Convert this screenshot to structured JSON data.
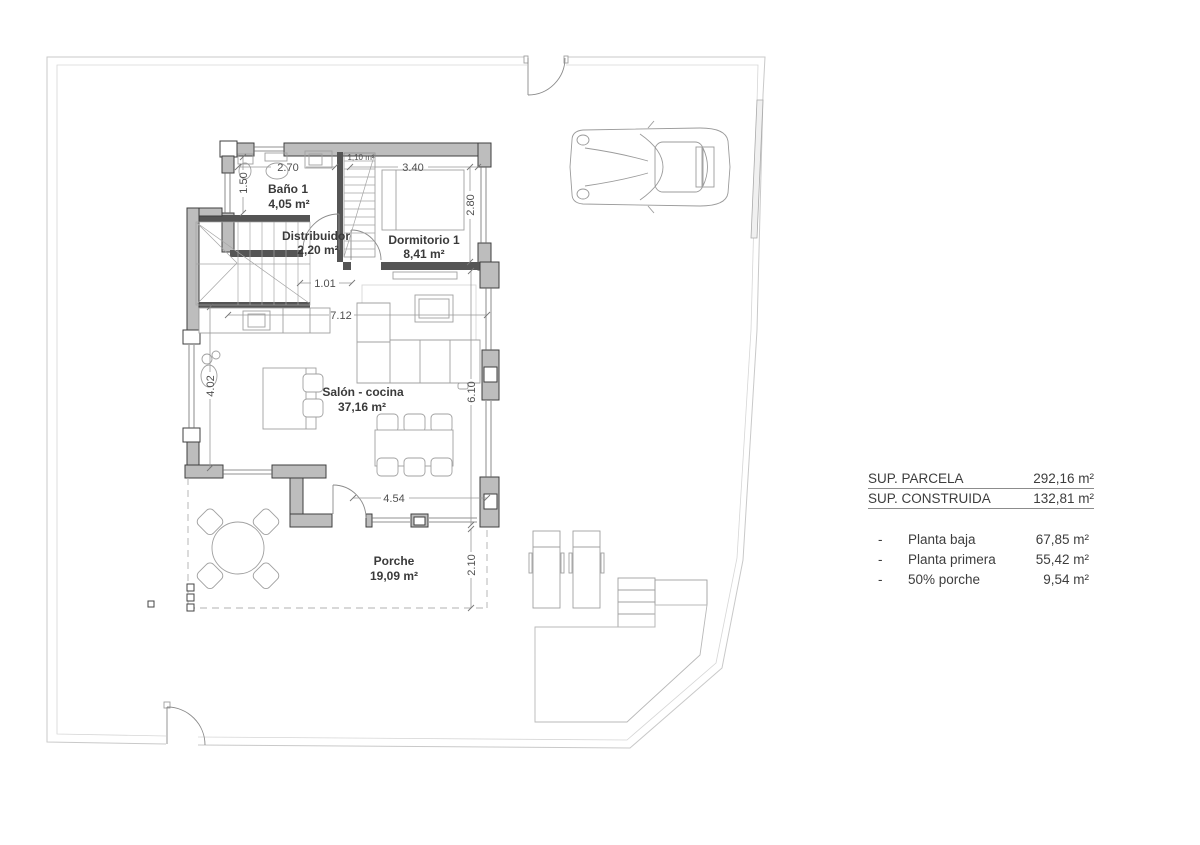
{
  "colors": {
    "wall_fill": "#bdbdbd",
    "wall_dark": "#555555",
    "wall_stroke": "#3f3f3f",
    "furniture_line": "#a0a0a0",
    "boundary_line": "#c9c9c9",
    "dashed_line": "#b0b0b0",
    "room_text": "#3a3a3a",
    "dim_text": "#4f4f4f",
    "summary_text": "#3d3d3d"
  },
  "rooms": {
    "bano": {
      "name": "Baño 1",
      "area": "4,05 m²"
    },
    "distribuidor": {
      "name": "Distribuidor",
      "area": "2,20 m²"
    },
    "dormitorio": {
      "name": "Dormitorio 1",
      "area": "8,41 m²"
    },
    "salon": {
      "name": "Salón - cocina",
      "area": "37,16 m²"
    },
    "porche": {
      "name": "Porche",
      "area": "19,09 m²"
    }
  },
  "dims": {
    "bano_width": "2.70",
    "stair_area": "1,10 m²",
    "dorm_width": "3.40",
    "bano_window": "1.50",
    "dorm_depth": "2.80",
    "hall_width": "1.01",
    "salon_width": "7.12",
    "salon_window_left": "4.02",
    "salon_window_right": "6.10",
    "porch_width": "4.54",
    "porch_depth": "2.10"
  },
  "summary": {
    "rows": [
      {
        "label": "SUP. PARCELA",
        "value": "292,16 m²"
      },
      {
        "label": "SUP. CONSTRUIDA",
        "value": "132,81 m²"
      }
    ],
    "items": [
      {
        "bullet": "-",
        "label": "Planta baja",
        "value": "67,85 m²"
      },
      {
        "bullet": "-",
        "label": "Planta primera",
        "value": "55,42 m²"
      },
      {
        "bullet": "-",
        "label": "50% porche",
        "value": "9,54 m²"
      }
    ]
  }
}
